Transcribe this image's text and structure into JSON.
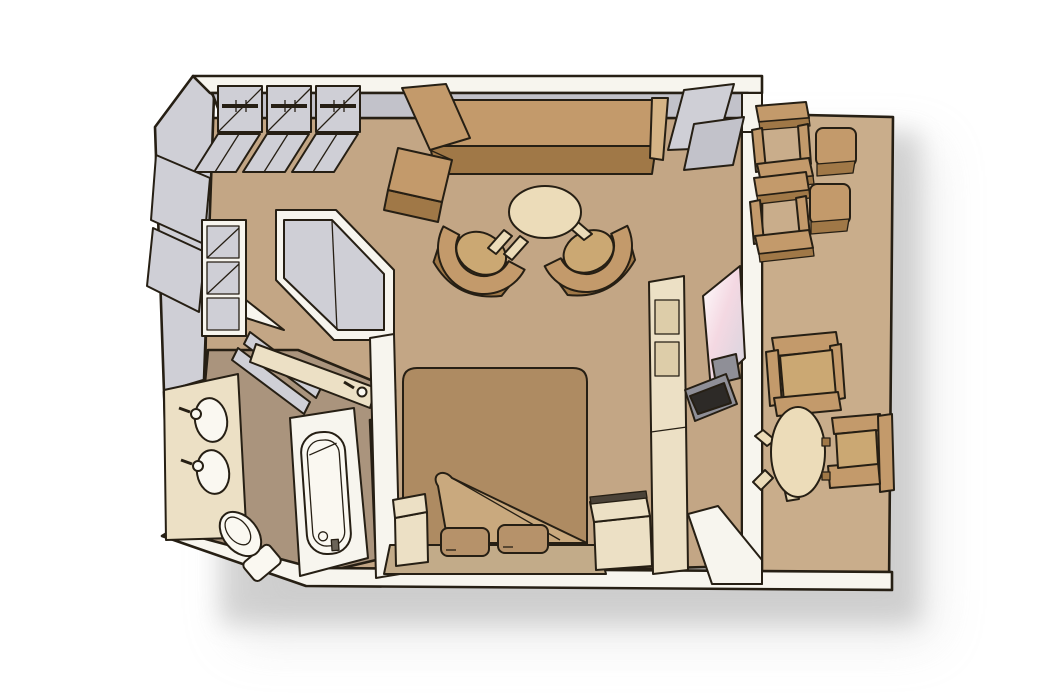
{
  "meta": {
    "type": "isometric-floor-plan",
    "description": "Isometric floor plan of a suite stateroom with wardrobe, bathroom, living area, bedroom and private balcony"
  },
  "palette": {
    "background": "#ffffff",
    "room_floor": "#c3a685",
    "balcony_floor": "#c9ad8b",
    "bathroom_floor": "#aa947d",
    "wall_top": "#cfcfd6",
    "wall_face": "#f7f5ee",
    "cabinetry_cream": "#ece0c5",
    "furniture_wood": "#c39a6b",
    "furniture_wood_shade": "#a07847",
    "bed_linen": "#ae8b62",
    "fixtures_white": "#faf8f1",
    "tv_screen": "#2d2a27",
    "outline": "#261f14"
  },
  "rooms": {
    "wardrobe": {
      "name": "wardrobe-area",
      "furniture": [
        "closet-bay-with-rod",
        "closet-bay-with-rod",
        "closet-bay-with-rod",
        "open-closet-doors",
        "shelf-unit"
      ]
    },
    "bathroom": {
      "name": "bathroom",
      "furniture": [
        "double-sink-vanity",
        "toilet",
        "bathtub",
        "shower-stall",
        "counter-with-faucet"
      ]
    },
    "living_area": {
      "name": "living-area",
      "furniture": [
        "l-shaped-sofa",
        "round-coffee-table",
        "tub-chair",
        "tub-chair"
      ]
    },
    "bedroom": {
      "name": "bedroom",
      "furniture": [
        "double-bed-turned-down",
        "pillow",
        "pillow",
        "nightstand",
        "nightstand",
        "tv-cabinet",
        "mirror",
        "tv"
      ]
    },
    "balcony": {
      "name": "private-balcony",
      "furniture": [
        "deck-chair",
        "deck-chair",
        "side-table",
        "side-table",
        "oval-table",
        "dining-chair",
        "dining-chair"
      ]
    }
  }
}
